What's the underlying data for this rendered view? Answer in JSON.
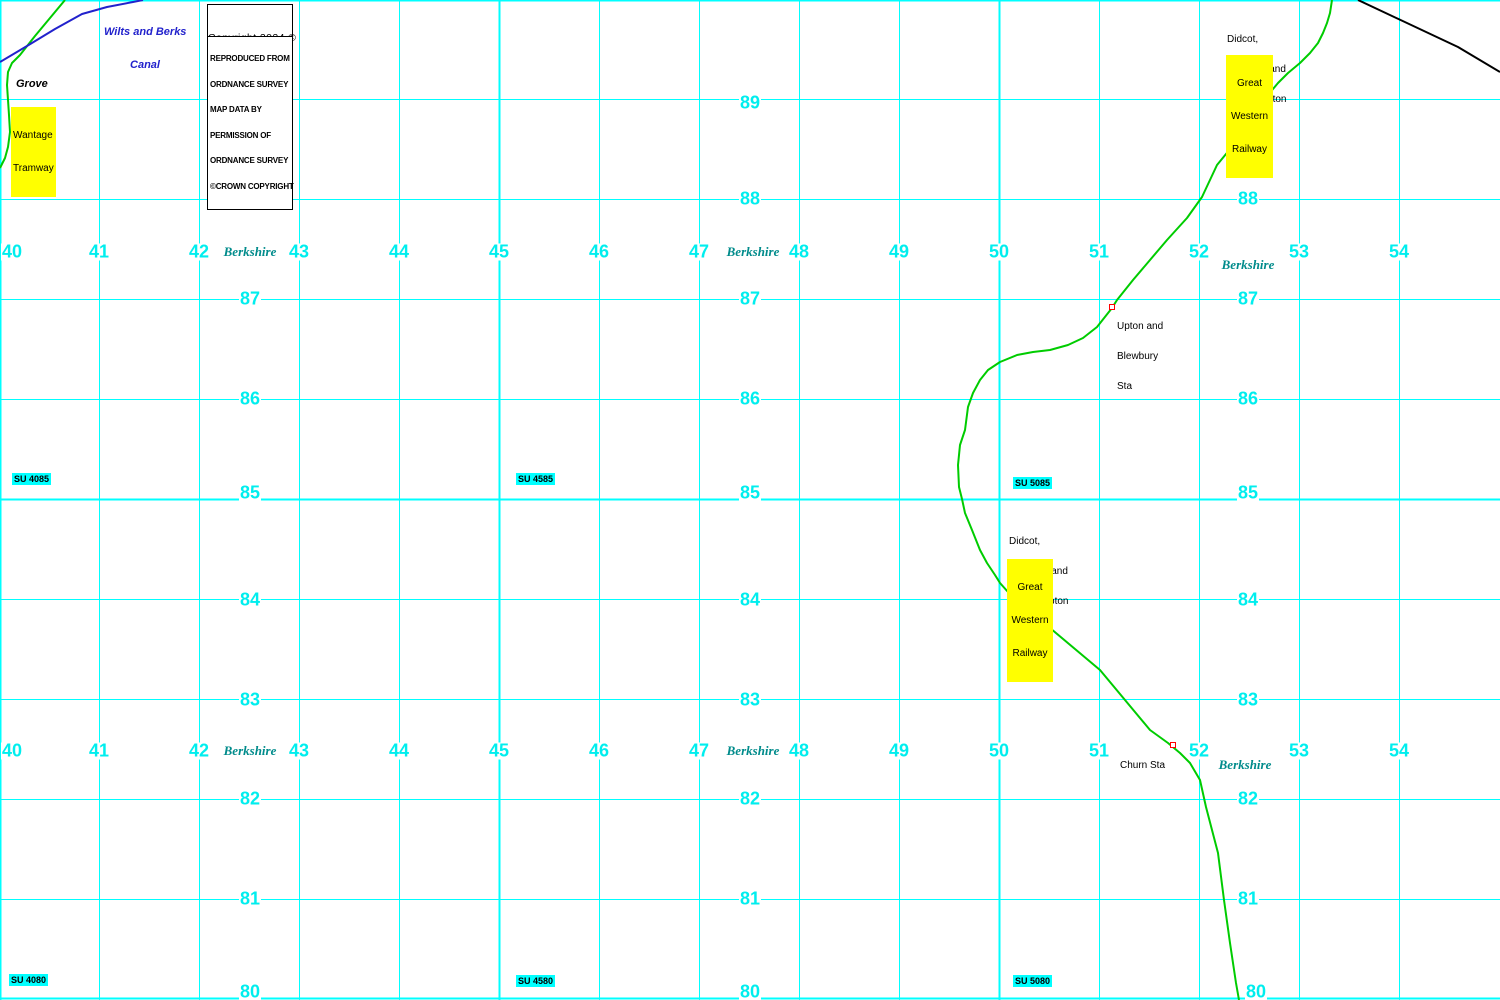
{
  "map": {
    "width": 1500,
    "height": 1000,
    "colors": {
      "grid": "#00ffff",
      "grid_numbers": "#00eeee",
      "grid_ref_background": "#00ffff",
      "county_text": "#008b8b",
      "railway_green": "#00cc00",
      "canal_blue": "#2222cc",
      "railway_black": "#000000",
      "station_marker_red": "#ff0000",
      "highlight_yellow": "#ffff00"
    },
    "grid": {
      "vline_xs": [
        0,
        99,
        199,
        299,
        399,
        499,
        599,
        699,
        799,
        899,
        999,
        1099,
        1199,
        1299,
        1399
      ],
      "vline_major_xs": [
        0,
        499,
        999
      ],
      "hline_ys": [
        0,
        99,
        199,
        299,
        399,
        499,
        599,
        699,
        799,
        899,
        998
      ],
      "hline_major_ys": [
        0,
        499,
        998
      ]
    },
    "easting_labels": {
      "values": [
        "40",
        "41",
        "42",
        "43",
        "44",
        "45",
        "46",
        "47",
        "48",
        "49",
        "50",
        "51",
        "52",
        "53",
        "54"
      ],
      "centers_x": [
        12,
        99,
        199,
        299,
        399,
        499,
        599,
        699,
        799,
        899,
        999,
        1099,
        1199,
        1299,
        1399
      ],
      "rows_y": [
        252,
        751
      ]
    },
    "northing_labels": {
      "cols_x": [
        250,
        750,
        1248
      ],
      "items": [
        {
          "v": "89",
          "y": 103
        },
        {
          "v": "88",
          "y": 199
        },
        {
          "v": "87",
          "y": 299
        },
        {
          "v": "86",
          "y": 399
        },
        {
          "v": "85",
          "y": 493
        },
        {
          "v": "84",
          "y": 600
        },
        {
          "v": "83",
          "y": 700
        },
        {
          "v": "82",
          "y": 799
        },
        {
          "v": "81",
          "y": 899
        },
        {
          "v": "80",
          "y": 992,
          "col3_x": 1256
        }
      ]
    },
    "su_refs": [
      {
        "text": "SU 4085",
        "x": 12,
        "y": 473
      },
      {
        "text": "SU 4585",
        "x": 516,
        "y": 473
      },
      {
        "text": "SU 5085",
        "x": 1013,
        "y": 477
      },
      {
        "text": "SU 4080",
        "x": 9,
        "y": 974
      },
      {
        "text": "SU 4580",
        "x": 516,
        "y": 975
      },
      {
        "text": "SU 5080",
        "x": 1013,
        "y": 975
      }
    ],
    "county_labels": [
      {
        "text": "Berkshire",
        "x": 250,
        "y": 252
      },
      {
        "text": "Berkshire",
        "x": 753,
        "y": 252
      },
      {
        "text": "Berkshire",
        "x": 1248,
        "y": 265
      },
      {
        "text": "Berkshire",
        "x": 250,
        "y": 751
      },
      {
        "text": "Berkshire",
        "x": 753,
        "y": 751
      },
      {
        "text": "Berkshire",
        "x": 1245,
        "y": 765
      }
    ],
    "routes": [
      {
        "name": "wantage-tramway-line",
        "color": "#00cc00",
        "width": 2,
        "points": [
          [
            65,
            0
          ],
          [
            50,
            18
          ],
          [
            35,
            36
          ],
          [
            20,
            55
          ],
          [
            12,
            63
          ],
          [
            8,
            72
          ],
          [
            7,
            85
          ],
          [
            8,
            100
          ],
          [
            9,
            115
          ],
          [
            10,
            132
          ],
          [
            8,
            147
          ],
          [
            5,
            158
          ],
          [
            0,
            168
          ]
        ]
      },
      {
        "name": "wilts-and-berks-canal-line",
        "color": "#2222cc",
        "width": 2,
        "points": [
          [
            0,
            62
          ],
          [
            27,
            46
          ],
          [
            55,
            29
          ],
          [
            82,
            14
          ],
          [
            107,
            7
          ],
          [
            133,
            2
          ],
          [
            143,
            0
          ]
        ]
      },
      {
        "name": "didcot-newbury-southampton-railway-line",
        "color": "#00cc00",
        "width": 2,
        "points": [
          [
            1332,
            0
          ],
          [
            1330,
            13
          ],
          [
            1327,
            23
          ],
          [
            1323,
            33
          ],
          [
            1318,
            43
          ],
          [
            1310,
            53
          ],
          [
            1300,
            63
          ],
          [
            1288,
            73
          ],
          [
            1278,
            83
          ],
          [
            1268,
            95
          ],
          [
            1253,
            115
          ],
          [
            1244,
            130
          ],
          [
            1235,
            143
          ],
          [
            1217,
            165
          ],
          [
            1202,
            197
          ],
          [
            1187,
            218
          ],
          [
            1167,
            240
          ],
          [
            1150,
            260
          ],
          [
            1133,
            280
          ],
          [
            1117,
            300
          ],
          [
            1112,
            308
          ],
          [
            1097,
            327
          ],
          [
            1083,
            338
          ],
          [
            1068,
            345
          ],
          [
            1050,
            350
          ],
          [
            1033,
            352
          ],
          [
            1017,
            355
          ],
          [
            1000,
            362
          ],
          [
            988,
            370
          ],
          [
            980,
            380
          ],
          [
            973,
            393
          ],
          [
            968,
            407
          ],
          [
            965,
            430
          ],
          [
            960,
            445
          ],
          [
            958,
            465
          ],
          [
            959,
            487
          ],
          [
            962,
            499
          ],
          [
            965,
            513
          ],
          [
            972,
            530
          ],
          [
            980,
            550
          ],
          [
            987,
            563
          ],
          [
            995,
            575
          ],
          [
            1000,
            583
          ],
          [
            1008,
            592
          ],
          [
            1018,
            600
          ],
          [
            1035,
            613
          ],
          [
            1043,
            620
          ],
          [
            1050,
            628
          ],
          [
            1100,
            670
          ],
          [
            1150,
            730
          ],
          [
            1168,
            743
          ],
          [
            1180,
            753
          ],
          [
            1190,
            763
          ],
          [
            1200,
            780
          ],
          [
            1206,
            807
          ],
          [
            1218,
            853
          ],
          [
            1224,
            900
          ],
          [
            1230,
            943
          ],
          [
            1236,
            983
          ],
          [
            1239,
            1000
          ]
        ]
      },
      {
        "name": "black-railway-line",
        "color": "#000000",
        "width": 2,
        "points": [
          [
            1358,
            0
          ],
          [
            1458,
            47
          ],
          [
            1500,
            72
          ]
        ]
      }
    ],
    "annotations": {
      "copyright": {
        "lines": [
          "Copyright 2024 ©",
          "KeymapsGB"
        ]
      },
      "os_attribution": {
        "lines": [
          "REPRODUCED FROM",
          "ORDNANCE SURVEY",
          "MAP DATA BY",
          "PERMISSION OF",
          "ORDNANCE SURVEY",
          "©CROWN COPYRIGHT"
        ]
      },
      "canal": {
        "lines": [
          "Wilts and Berks",
          "Canal"
        ]
      },
      "grove_bridge": {
        "lines": [
          "Grove",
          "Bridge"
        ]
      },
      "wantage": {
        "lines": [
          "Wantage",
          "Tramway"
        ]
      },
      "didcot_north": {
        "lines": [
          "Didcot,",
          "Newbury and",
          "Southampton",
          "Railway"
        ]
      },
      "gwr_north": {
        "lines": [
          "Great",
          "Western",
          "Railway"
        ]
      },
      "didcot_mid": {
        "lines": [
          "Didcot,",
          "Newbury and",
          "Southampton",
          "Railway"
        ]
      },
      "gwr_mid": {
        "lines": [
          "Great",
          "Western",
          "Railway"
        ]
      },
      "upton_station": {
        "lines": [
          "Upton and",
          "Blewbury",
          "Sta"
        ]
      },
      "churn_station": {
        "lines": [
          "Churn Sta"
        ]
      }
    }
  }
}
